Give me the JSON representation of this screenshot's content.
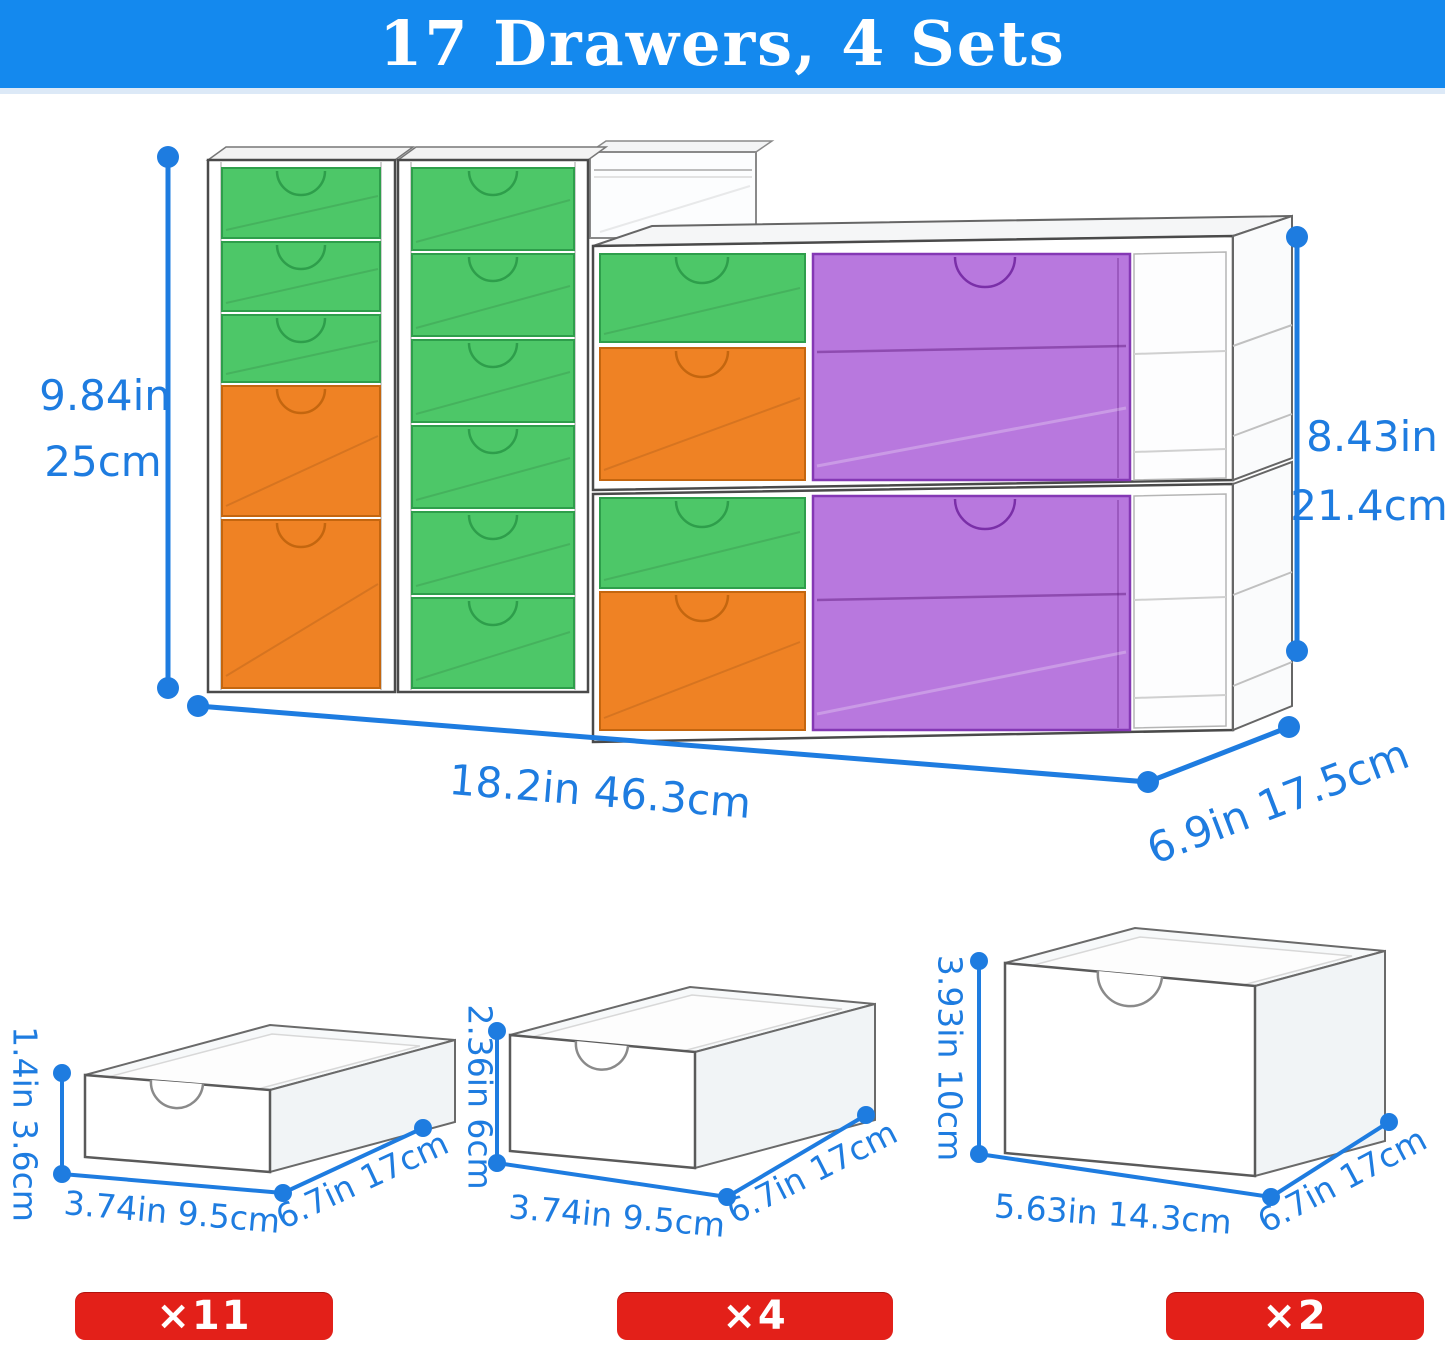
{
  "header": {
    "title": "17 Drawers, 4 Sets"
  },
  "colors": {
    "header_blue": "#1489ee",
    "dimension_blue": "#1e7ce0",
    "drawer_green": "#4dc768",
    "drawer_orange": "#ef8224",
    "drawer_purple": "#b878de",
    "badge_red": "#e32019"
  },
  "main_unit": {
    "left_height_in": "9.84in",
    "left_height_cm": "25cm",
    "right_height_in": "8.43in",
    "right_height_cm": "21.4cm",
    "width": "18.2in 46.3cm",
    "depth": "6.9in 17.5cm"
  },
  "drawer_sizes": [
    {
      "id": "small",
      "height": "1.4in 3.6cm",
      "width": "3.74in 9.5cm",
      "depth": "6.7in 17cm",
      "count": "×11"
    },
    {
      "id": "medium",
      "height": "2.36in 6cm",
      "width": "3.74in 9.5cm",
      "depth": "6.7in 17cm",
      "count": "×4"
    },
    {
      "id": "large",
      "height": "3.93in 10cm",
      "width": "5.63in 14.3cm",
      "depth": "6.7in 17cm",
      "count": "×2"
    }
  ]
}
